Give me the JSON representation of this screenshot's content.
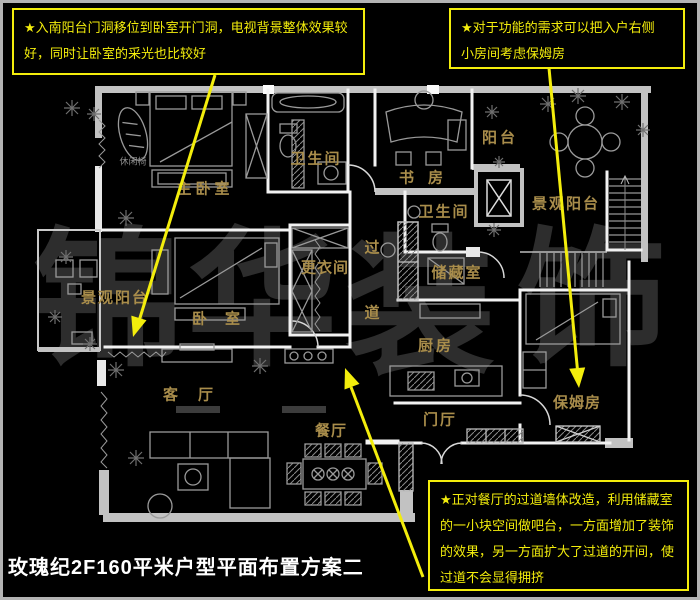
{
  "title": {
    "text": "玫瑰纪2F160平米户型平面布置方案二"
  },
  "colors": {
    "background": "#000000",
    "annotation_yellow": "#f3ed0c",
    "room_label_gold": "#a98d4b",
    "wall_white": "#f2f2f2",
    "window_gray": "#c2c2c2",
    "furniture_gray": "#9a9a9a",
    "watermark_gray": "#2d2d2d",
    "title_white": "#ffffff",
    "frame_gray": "#b3b3b3"
  },
  "annotations": {
    "note_top_left": {
      "lines": [
        "★入南阳台门洞移位到卧室开门洞，电视背景整体效果较",
        "好，同时让卧室的采光也比较好"
      ]
    },
    "note_top_right": {
      "lines": [
        "★对于功能的需求可以把入户右侧",
        "小房间考虑保姆房"
      ]
    },
    "note_bottom_right": {
      "lines": [
        "★正对餐厅的过道墙体改造，利用储藏室",
        "的一小块空间做吧台，一方面增加了装饰",
        "的效果，另一方面扩大了过道的开间，使",
        "过道不会显得拥挤"
      ]
    }
  },
  "floorplan": {
    "rooms": [
      {
        "id": "room-label-master-bedroom",
        "label": "主卧室",
        "x": 205,
        "y": 188,
        "ls": 4
      },
      {
        "id": "room-label-bathroom-top",
        "label": "卫生间",
        "x": 316,
        "y": 158,
        "ls": 2
      },
      {
        "id": "room-label-study",
        "label": "书房",
        "x": 428,
        "y": 177,
        "ls": 14
      },
      {
        "id": "room-label-balcony-small",
        "label": "阳台",
        "x": 500,
        "y": 137,
        "ls": 3
      },
      {
        "id": "room-label-view-balcony-right",
        "label": "景观阳台",
        "x": 566,
        "y": 203,
        "ls": 2
      },
      {
        "id": "room-label-bathroom-mid",
        "label": "卫生间",
        "x": 444,
        "y": 211,
        "ls": 2
      },
      {
        "id": "room-label-corridor-char-1",
        "label": "过",
        "x": 372,
        "y": 247,
        "ls": 0
      },
      {
        "id": "room-label-corridor-char-2",
        "label": "道",
        "x": 372,
        "y": 312,
        "ls": 0
      },
      {
        "id": "room-label-dressing-room",
        "label": "更衣间",
        "x": 325,
        "y": 267,
        "ls": 1
      },
      {
        "id": "room-label-storage-room",
        "label": "储藏室",
        "x": 457,
        "y": 272,
        "ls": 2
      },
      {
        "id": "room-label-kitchen",
        "label": "厨房",
        "x": 436,
        "y": 345,
        "ls": 3
      },
      {
        "id": "room-label-view-balcony-left",
        "label": "景观阳台",
        "x": 115,
        "y": 297,
        "ls": 2
      },
      {
        "id": "room-label-bedroom-2",
        "label": "卧室",
        "x": 225,
        "y": 318,
        "ls": 18
      },
      {
        "id": "room-label-living-room",
        "label": "客厅",
        "x": 198,
        "y": 394,
        "ls": 20
      },
      {
        "id": "room-label-dining-room",
        "label": "餐厅",
        "x": 331,
        "y": 430,
        "ls": 1
      },
      {
        "id": "room-label-entry-hall",
        "label": "门厅",
        "x": 440,
        "y": 419,
        "ls": 2
      },
      {
        "id": "room-label-nanny-room",
        "label": "保姆房",
        "x": 577,
        "y": 402,
        "ls": 1
      }
    ],
    "small_labels": [
      {
        "id": "furniture-label-leisure-chair",
        "label": "休闲椅",
        "x": 133,
        "y": 161
      }
    ],
    "watermark": {
      "text": "锦华装饰",
      "chars": [
        {
          "id": "watermark-char-1",
          "label": "锦",
          "x": 108,
          "y": 300
        },
        {
          "id": "watermark-char-2",
          "label": "华",
          "x": 262,
          "y": 300
        },
        {
          "id": "watermark-char-3",
          "label": "装",
          "x": 420,
          "y": 308
        },
        {
          "id": "watermark-char-4",
          "label": "饰",
          "x": 592,
          "y": 300
        }
      ]
    }
  }
}
